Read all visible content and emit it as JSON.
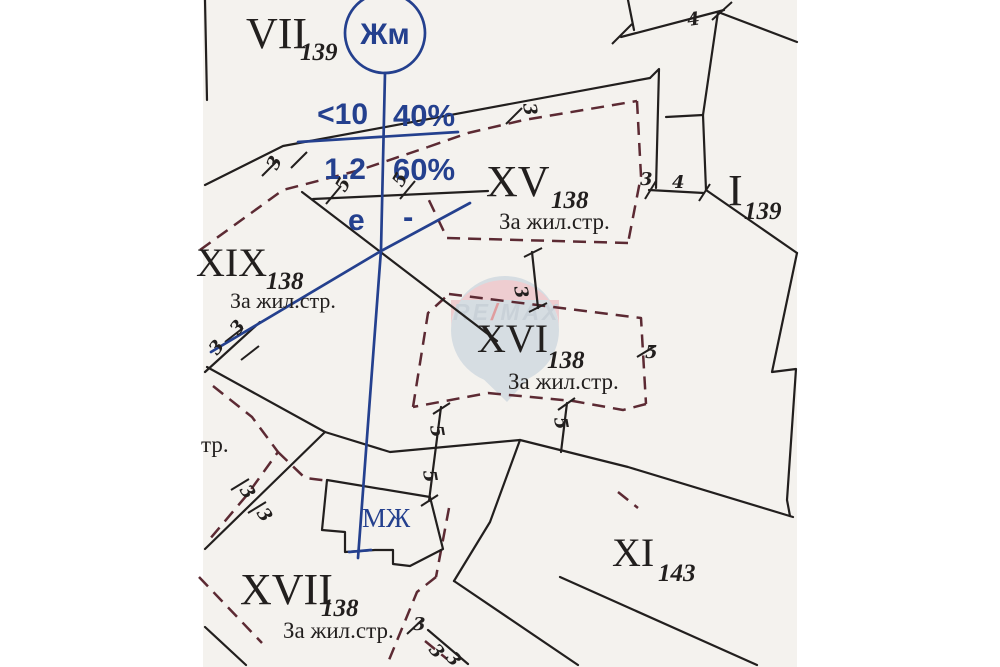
{
  "colors": {
    "page_bg": "#ffffff",
    "paper": "#f4f2ee",
    "ink": "#221f1e",
    "boundary_dash": "#5c2a33",
    "blue": "#24408e",
    "wm_blue": "#b9c9d8",
    "wm_pink": "#e9aab4",
    "wm_red": "#cc4a52"
  },
  "parcels": {
    "vii": {
      "numeral": "VII",
      "sub": "139"
    },
    "xv": {
      "numeral": "XV",
      "sub": "138",
      "use": "За жил.стр."
    },
    "xix": {
      "numeral": "XIX",
      "sub": "138",
      "use": "За жил.стр."
    },
    "xvi": {
      "numeral": "XVI",
      "sub": "138",
      "use": "За жил.стр."
    },
    "xvii": {
      "numeral": "XVII",
      "sub": "138",
      "use": "За жил.стр."
    },
    "i": {
      "numeral": "I",
      "sub": "139"
    },
    "xi": {
      "numeral": "XI",
      "sub": "143"
    }
  },
  "zoning": {
    "circle": "Жм",
    "r1c1": "<10",
    "r1c2": "40%",
    "r2c1": "1.2",
    "r2c2": "60%",
    "r3c1": "е",
    "r3c2": "-"
  },
  "labels": {
    "building": "МЖ",
    "street_fragment": "тр."
  },
  "watermark": {
    "re": "RE",
    "slash": "/",
    "max": "MAX"
  },
  "dimensions": [
    "3",
    "4",
    "3",
    "4",
    "3",
    "3",
    "5",
    "5",
    "3",
    "3",
    "3",
    "3",
    "5",
    "5",
    "5",
    "5",
    "3",
    "3",
    "3"
  ]
}
